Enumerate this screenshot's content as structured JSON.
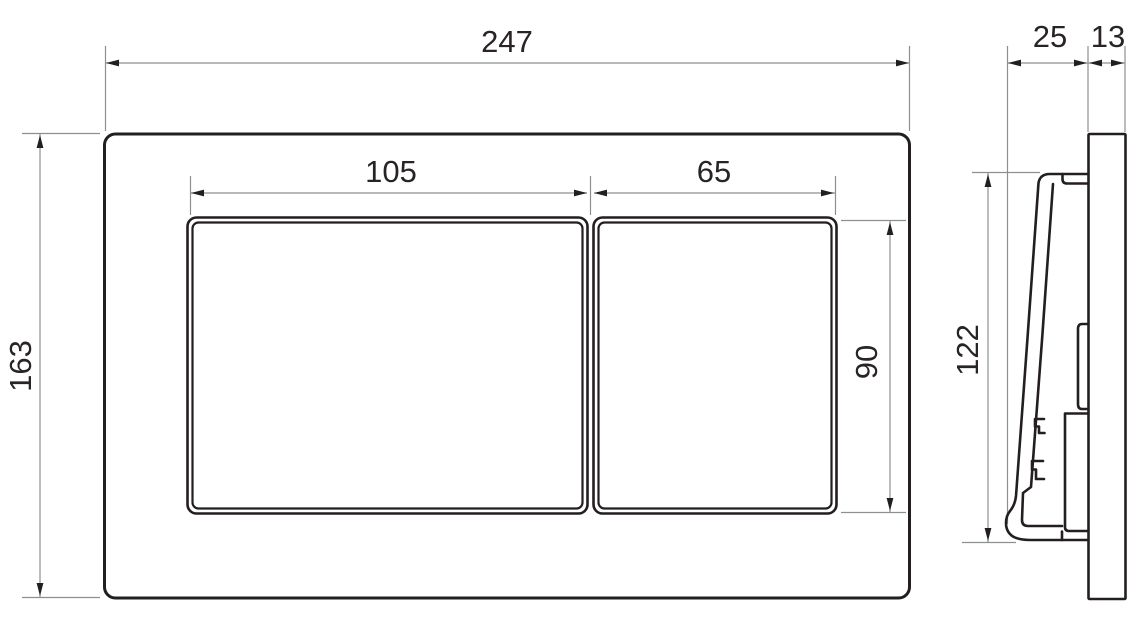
{
  "colors": {
    "background": "#ffffff",
    "object_line": "#241f1f",
    "dimension_line": "#8d8f91",
    "text": "#292424"
  },
  "drawing": {
    "front_view": {
      "plate_width": "247",
      "plate_height": "163",
      "large_button_width": "105",
      "small_button_width": "65",
      "button_height": "90"
    },
    "side_view": {
      "button_depth": "25",
      "plate_depth": "13",
      "button_height": "122"
    }
  }
}
